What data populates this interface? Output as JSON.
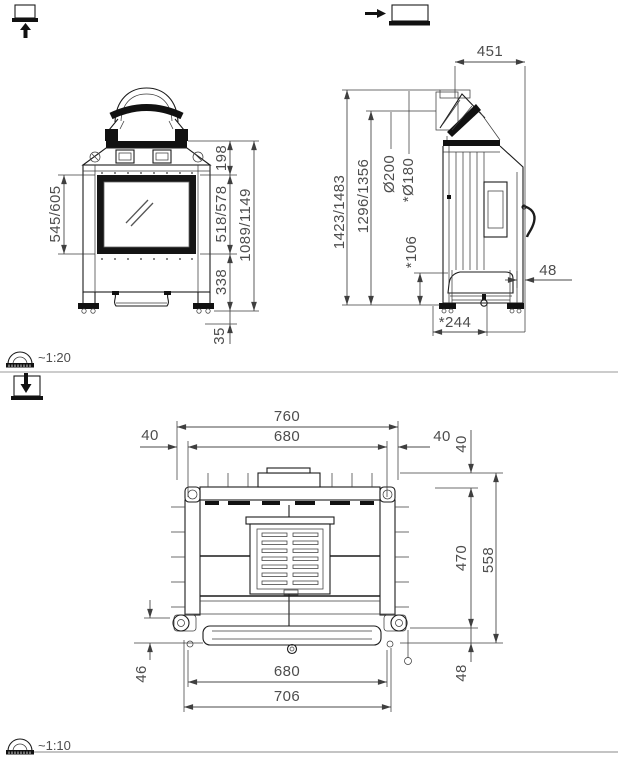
{
  "front_view": {
    "dims": {
      "glass_height": "545/605",
      "top_section": "198",
      "door_height": "518/578",
      "base_height": "338",
      "feet_height": "35",
      "total_height": "1089/1149"
    }
  },
  "side_view": {
    "dims": {
      "top_depth": "451",
      "total_height": "1423/1483",
      "flue_height": "1296/1356",
      "flue_outer_dia": "Ø200",
      "flue_inner_dia": "*Ø180",
      "base_height": "*106",
      "rear_offset": "48",
      "base_depth": "*244"
    }
  },
  "top_view": {
    "dims": {
      "overall_width": "760",
      "inner_width_top": "680",
      "margin_left": "40",
      "margin_right": "40",
      "margin_top": "40",
      "body_depth": "470",
      "overall_depth": "558",
      "front_offset_left": "46",
      "inner_width_bottom": "680",
      "frame_width": "706",
      "front_offset_right": "48"
    }
  },
  "scales": {
    "front_side_scale": "~1:20",
    "top_scale": "~1:10"
  },
  "icons": {
    "top_left": "front-view-icon",
    "top_right": "side-view-icon",
    "section_2": "top-view-icon",
    "scale_icon": "protractor-icon"
  }
}
